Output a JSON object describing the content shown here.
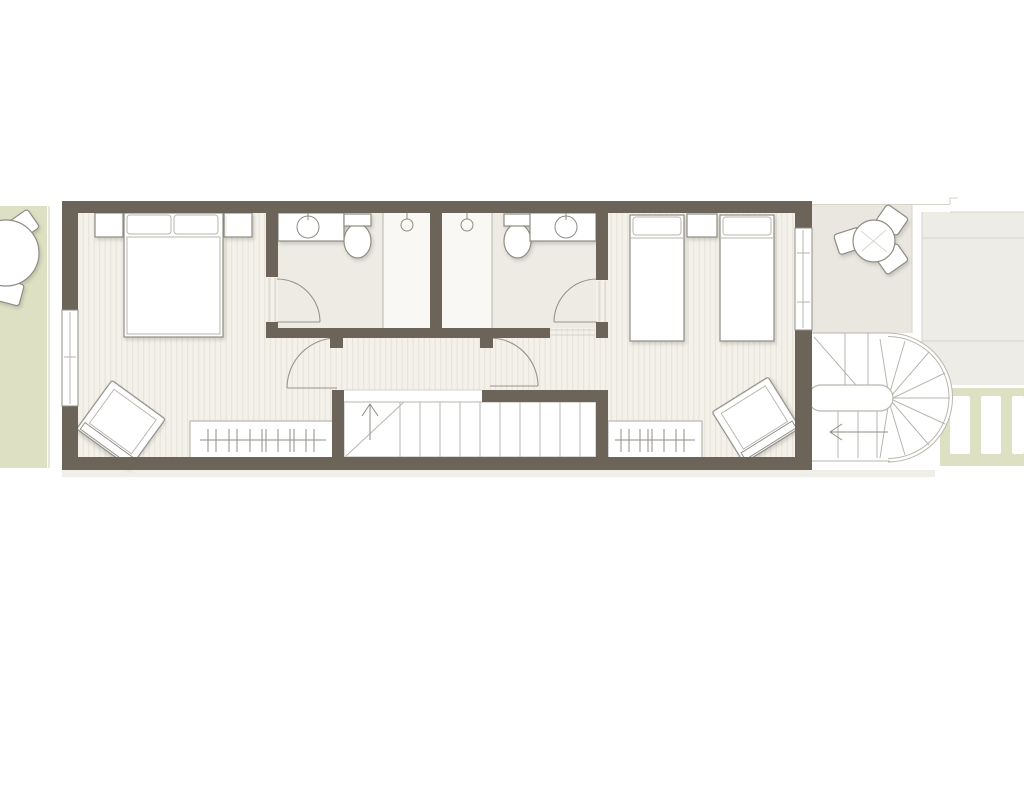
{
  "canvas": {
    "width": 1024,
    "height": 800
  },
  "drawing_type": "architectural floor plan, upper storey of a narrow terraced house, no text labels",
  "colors": {
    "paper": "#ffffff",
    "wall": "#6c6459",
    "floor_base": "#f3f1ea",
    "floor_stripe": "#e7e4d9",
    "bath_floor": "#edebe4",
    "shower_floor": "#f9f8f5",
    "garden": "#dde0c2",
    "garden_edge": "#ced1b4",
    "terrace": "#e9e7e0",
    "neighbor": "#edece6",
    "shadow_band": "#efeee9",
    "furn_stroke": "#8f8c84",
    "thin": "#b9b6ae",
    "faint": "#d6d3cb",
    "door": "#97948c",
    "table_detail": "#d9d6ce"
  },
  "floorplan": {
    "left_garden": {
      "type": "roof-garden strip",
      "furniture": [
        "round-table",
        "chair",
        "chair"
      ]
    },
    "master_bedroom": {
      "furniture": [
        "double-bed",
        "nightstand-left",
        "nightstand-right",
        "armchair",
        "wardrobe-with-hangers",
        "window-left-wall"
      ]
    },
    "ensuite_1": {
      "fixtures": [
        "washbasin-counter",
        "toilet",
        "shower-with-head"
      ],
      "door": "quarter-swing into room"
    },
    "ensuite_2": {
      "fixtures": [
        "shower-with-head",
        "toilet",
        "washbasin-counter"
      ],
      "door": "quarter-swing into room"
    },
    "hallway": {
      "doors": 2,
      "openings": [
        "to-master-bedroom",
        "to-bedroom-2"
      ]
    },
    "central_staircase": {
      "treads": 10,
      "direction_arrow": "up",
      "break_line": "diagonal"
    },
    "bedroom_2": {
      "furniture": [
        "single-bed",
        "single-bed",
        "nightstand",
        "armchair",
        "wardrobe-with-hangers",
        "window-right-wall"
      ]
    },
    "rear_terrace": {
      "furniture": [
        "round-table",
        "chair",
        "chair",
        "chair"
      ]
    },
    "external_stair": {
      "type": "U-shaped winder stair with stadium-shaped core and curved outer edge",
      "direction_arrow": "left"
    },
    "rear_path": {
      "type": "green strip with white slats",
      "slats": 3
    },
    "neighbor_outline": {
      "type": "adjacent plot shown as faint outline"
    }
  }
}
